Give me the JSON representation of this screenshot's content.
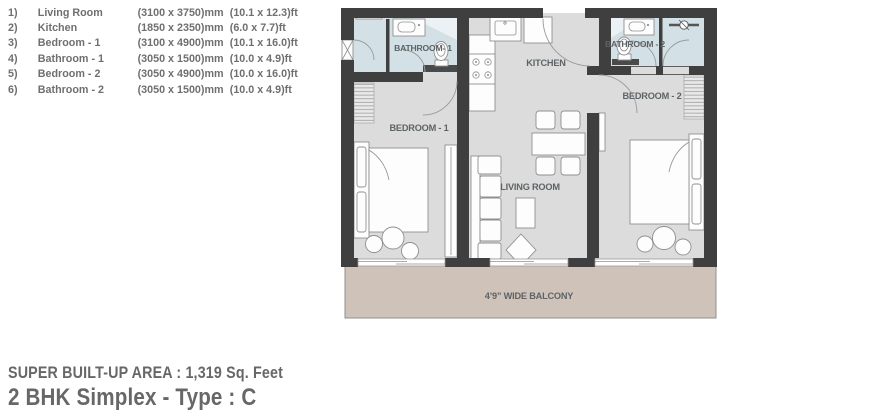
{
  "colors": {
    "wall": "#3f3f3f",
    "floor": "#dcdcdc",
    "wet": "#d3e1e6",
    "balcony": "#cfc2b8",
    "balcony-border": "#8f8f8f",
    "plantext": "#5d6366",
    "legendtext": "#6f6f6f",
    "titletext": "#676767"
  },
  "legend": {
    "items": [
      {
        "num": "1)",
        "name": "Living Room",
        "mm": "(3100 x 3750)mm",
        "ft": "(10.1 x 12.3)ft"
      },
      {
        "num": "2)",
        "name": "Kitchen",
        "mm": "(1850 x 2350)mm",
        "ft": "(6.0 x 7.7)ft"
      },
      {
        "num": "3)",
        "name": "Bedroom - 1",
        "mm": "(3100 x 4900)mm",
        "ft": "(10.1 x 16.0)ft"
      },
      {
        "num": "4)",
        "name": "Bathroom - 1",
        "mm": "(3050 x 1500)mm",
        "ft": "(10.0 x 4.9)ft"
      },
      {
        "num": "5)",
        "name": "Bedroom - 2",
        "mm": "(3050 x 4900)mm",
        "ft": "(10.0 x 16.0)ft"
      },
      {
        "num": "6)",
        "name": "Bathroom - 2",
        "mm": "(3050 x 1500)mm",
        "ft": "(10.0 x 4.9)ft"
      }
    ]
  },
  "plan": {
    "labels": {
      "bathroom1": "BATHROOM- 1",
      "kitchen": "KITCHEN",
      "bathroom2": "BATHROOM - 2",
      "bedroom1": "BEDROOM - 1",
      "bedroom2": "BEDROOM - 2",
      "living": "LIVING ROOM",
      "balcony": "4’9” WIDE BALCONY"
    }
  },
  "footer": {
    "area": "SUPER BUILT-UP AREA : 1,319 Sq. Feet",
    "title": "2 BHK Simplex - Type : C"
  }
}
